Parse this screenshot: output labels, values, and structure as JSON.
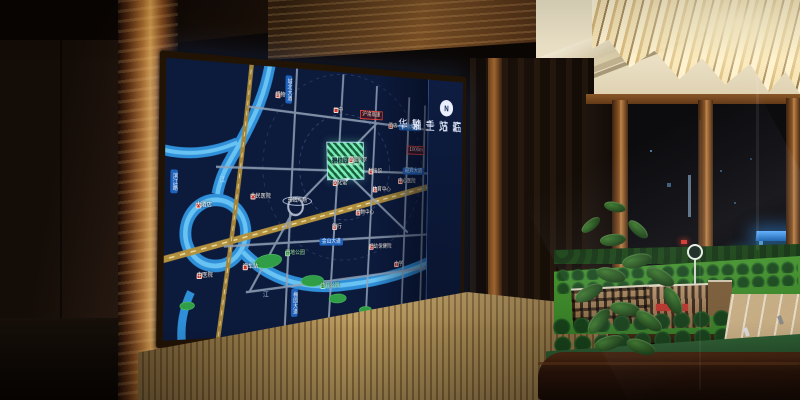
{
  "screen": {
    "panel": {
      "compass": "N",
      "slogan_line1": "临站主轴",
      "slogan_line2": "汇万千繁华"
    },
    "map": {
      "project_label": "碧桂园项目",
      "scale_label": "1000m",
      "river_char_1": "江",
      "river_char_2": "江",
      "pois": [
        {
          "label": "人民医院"
        },
        {
          "label": "大酒店"
        },
        {
          "label": "东站广场"
        },
        {
          "label": "博物馆"
        },
        {
          "label": "一中"
        },
        {
          "label": "沪渝高速"
        },
        {
          "label": "酒店"
        },
        {
          "label": "实验小学"
        },
        {
          "label": "科技馆"
        },
        {
          "label": "文化馆"
        },
        {
          "label": "体育中心"
        },
        {
          "label": "中心医院"
        },
        {
          "label": "购物中心"
        },
        {
          "label": "银行"
        },
        {
          "label": "湿地公园"
        },
        {
          "label": "汽车站"
        },
        {
          "label": "中医院"
        },
        {
          "label": "妇幼保健院"
        },
        {
          "label": "小学"
        },
        {
          "label": "体育公园"
        }
      ],
      "roads": [
        {
          "label": "城北大道"
        },
        {
          "label": "站前大道"
        },
        {
          "label": "迎宾大道"
        },
        {
          "label": "金山大道"
        },
        {
          "label": "滨江路"
        },
        {
          "label": "梅园大道"
        }
      ]
    }
  },
  "model": {
    "base_slogan": "碧桂园 · 给您一个五星级的家"
  }
}
